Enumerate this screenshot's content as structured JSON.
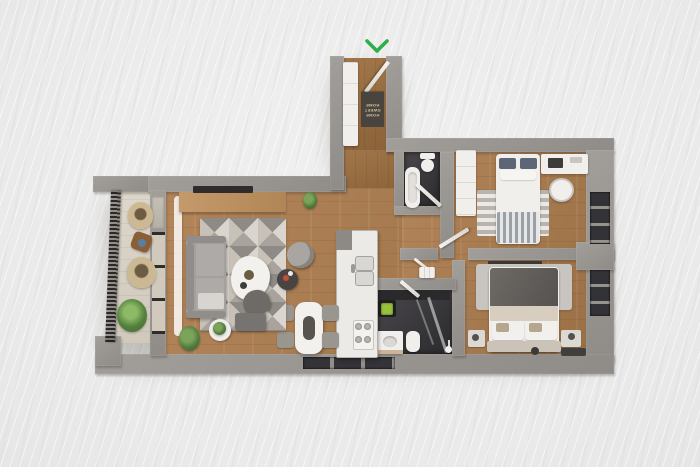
{
  "scene": {
    "description": "3D top-down architectural render of an apartment floor plan on a light streaked background",
    "background_color": "#ededed",
    "entrance": {
      "marker_icon": "chevron-down-icon",
      "marker_color": "#2fae49",
      "doormat": {
        "line1": "HOME",
        "line2": "SWEET",
        "line3": "HOME"
      }
    },
    "palette": {
      "wall": "#8f8b87",
      "wall_light": "#a29e9a",
      "wood": "#b3855a",
      "wood_dark": "#9a7045",
      "tile_dark": "#3a383a",
      "balcony_floor": "#d8d2c7",
      "white_furniture": "#f1efec",
      "accent_green": "#2fae49"
    },
    "rooms": [
      {
        "name": "entry-hall",
        "floor": "wood"
      },
      {
        "name": "living-room",
        "floor": "wood"
      },
      {
        "name": "dining-area",
        "floor": "wood"
      },
      {
        "name": "kitchen",
        "floor": "wood"
      },
      {
        "name": "hallway",
        "floor": "wood"
      },
      {
        "name": "balcony",
        "floor": "stone"
      },
      {
        "name": "guest-bathroom",
        "floor": "dark-tile"
      },
      {
        "name": "master-bathroom-laundry",
        "floor": "dark-tile"
      },
      {
        "name": "bedroom-north",
        "floor": "wood"
      },
      {
        "name": "bedroom-south",
        "floor": "wood"
      }
    ],
    "furniture": [
      "sofa",
      "coffee-table",
      "tv-console",
      "television",
      "geometric-area-rug",
      "armchair",
      "ottoman",
      "swivel-chair",
      "side-tables",
      "dining-table",
      "dining-chairs",
      "kitchen-island",
      "kitchen-sink",
      "stove",
      "double-bed",
      "single-bed",
      "wardrobe",
      "entry-closet",
      "desk",
      "desk-chair",
      "nightstands",
      "bathtub",
      "toilets",
      "shower",
      "washing-machine",
      "balcony-wicker-chairs",
      "balcony-table",
      "potted-plants",
      "doormat"
    ]
  }
}
